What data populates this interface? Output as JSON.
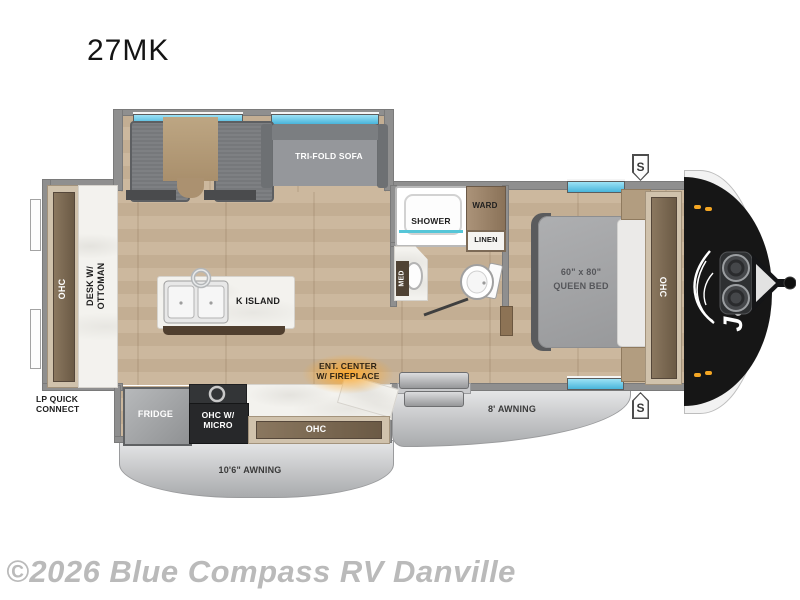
{
  "page": {
    "title": "27MK",
    "watermark": "©2026 Blue Compass RV Danville"
  },
  "colors": {
    "floor_tan": "#c8b49b",
    "wall_gray": "#8f8f8f",
    "awning_gray": "#c4c5c7",
    "window_blue": "#49b5da",
    "front_cap_black": "#161616",
    "fireplace_glow": "#ffa726",
    "marble_white": "#f3f2ee",
    "cabinet_brown": "#6b5a45"
  },
  "floorplan": {
    "slideout": {
      "sofa_label": "TRI-FOLD SOFA"
    },
    "rear": {
      "ohc_label": "OHC",
      "desk_label_line1": "DESK W/",
      "desk_label_line2": "OTTOMAN",
      "lp_line1": "LP QUICK",
      "lp_line2": "CONNECT"
    },
    "kitchen": {
      "island_label": "K ISLAND",
      "fridge_label": "FRIDGE",
      "micro_line1": "OHC W/",
      "micro_line2": "MICRO",
      "ohc_label": "OHC",
      "ent_line1": "ENT. CENTER",
      "ent_line2": "W/ FIREPLACE"
    },
    "bath": {
      "shower_label": "SHOWER",
      "ward_label": "WARD",
      "linen_label": "LINEN",
      "med_label": "MED"
    },
    "bedroom": {
      "bed_line1": "60\" x 80\"",
      "bed_line2": "QUEEN BED",
      "ohc_label": "OHC"
    },
    "exterior": {
      "awning_door": "8' AWNING",
      "awning_kitchen": "10'6\" AWNING",
      "speaker_top": "S",
      "speaker_bottom": "S",
      "brand": "Jayco"
    }
  }
}
